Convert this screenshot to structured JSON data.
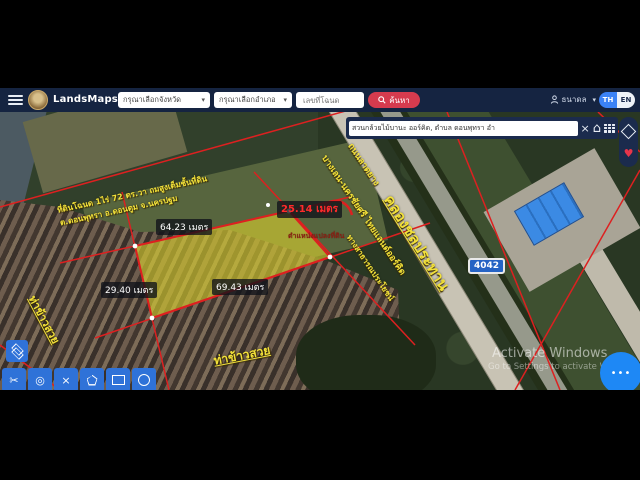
{
  "navbar": {
    "title": "LandsMaps",
    "province_select": "กรุณาเลือกจังหวัด",
    "district_select": "กรุณาเลือกอำเภอ",
    "deed_placeholder": "เลขที่โฉนด",
    "search_label": "ค้นหา",
    "username": "ธนาดล",
    "lang_th": "TH",
    "lang_en": "EN",
    "accent_color": "#d63b4e",
    "bar_color": "#152441"
  },
  "map_search": {
    "query": "สวนกล้วยไม้บานะ ออร์คิด, ตำบล ดอนพุทรา อำ"
  },
  "annotations": {
    "parcel_info_line1": "ที่ดินโฉนด 1ไร่ 72 ตร.วา ถมสูงเต็มชั้นที่ดิน",
    "parcel_info_line2": "ต.ดอนพุทรา อ.ดอนตูม จ.นครปฐม",
    "road_surface": "ถนนลาดยาง",
    "road_name": "บางเลน-นครชัยศรี ไทยแลนด์ออร์คิด",
    "canal": "คลองชลประทาน",
    "public_way": "ทางสาธารณประโยชน์",
    "parcel_position": "ตำแหน่งแปลงที่ดิน",
    "pier_bottom": "ท่าข้าวสวย",
    "pier_left": "ท่าข้าวสวย",
    "route_badge": "4042",
    "parcel_fill": "#d8cf2e",
    "line_color": "#dd2020",
    "label_color": "#f2e13a"
  },
  "measurements": [
    {
      "text": "64.23 เมตร"
    },
    {
      "text": "25.14 เมตร"
    },
    {
      "text": "29.40 เมตร"
    },
    {
      "text": "69.43 เมตร"
    }
  ],
  "icons": {
    "caret": "▾",
    "close": "×",
    "heart": "♥",
    "home": "⌂",
    "scissors": "✂",
    "target": "◎",
    "cross": "×",
    "dots": "•••"
  },
  "watermark": {
    "line1": "Activate Windows",
    "line2": "Go to Settings to activate Windows"
  }
}
